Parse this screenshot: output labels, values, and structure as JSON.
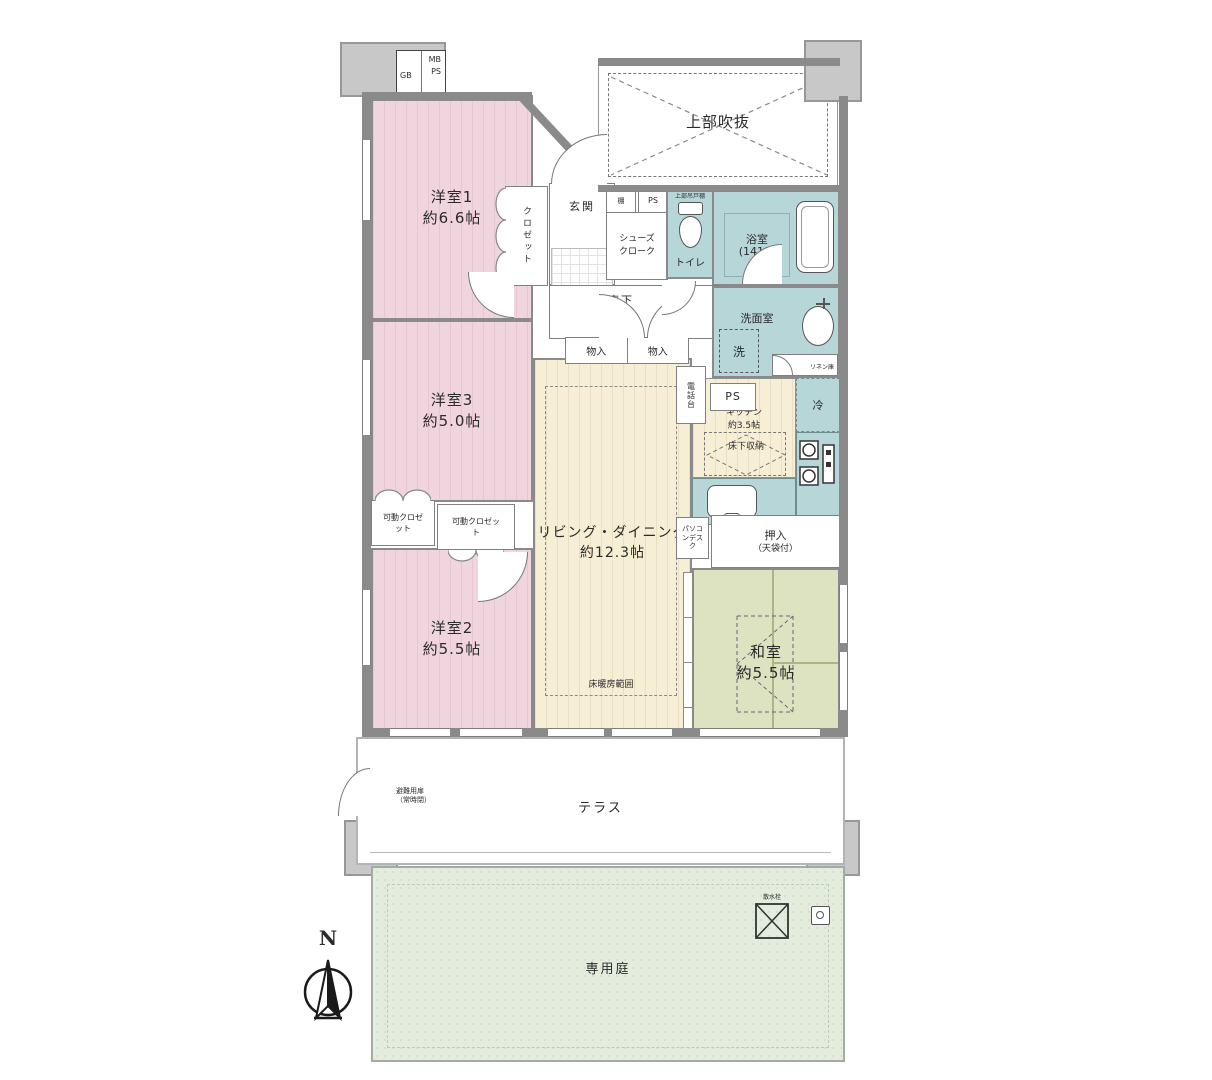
{
  "palette": {
    "bedroom_pink": "#f0d4de",
    "living_cream": "#f6efd6",
    "wet_area_blue": "#b7d6d8",
    "tatami_green": "#dde3c1",
    "garden_green": "#e4eddd",
    "wall_gray": "#8a8a8a"
  },
  "compass": {
    "north": "N"
  },
  "meter_box": {
    "gb": "GB",
    "mb": "MB",
    "ps": "PS"
  },
  "atrium": {
    "label": "上部吹抜"
  },
  "entrance": {
    "label": "玄関",
    "shoes_cloak": "シューズクローク",
    "shelf": "棚",
    "ps": "PS"
  },
  "hallway": {
    "label": "廊下",
    "storage_left": "物入",
    "storage_right": "物入"
  },
  "bedroom1": {
    "name": "洋室1",
    "area": "約6.6帖",
    "closet": "クロゼット"
  },
  "bedroom3": {
    "name": "洋室3",
    "area": "約5.0帖"
  },
  "bedroom2": {
    "name": "洋室2",
    "area": "約5.5帖"
  },
  "movable_closets": {
    "left": "可動クロゼット",
    "right": "可動クロゼット"
  },
  "living": {
    "name": "リビング・ダイニング",
    "area": "約12.3帖",
    "floor_heating": "床暖房範囲",
    "pc_desk": "パソコンデスク",
    "phone_stand": "電話台",
    "ps": "PS"
  },
  "kitchen": {
    "name": "キッチン",
    "area": "約3.5帖",
    "underfloor": "床下収納",
    "fridge": "冷"
  },
  "toilet": {
    "name": "トイレ",
    "upper_cabinet": "上部吊戸棚"
  },
  "bath": {
    "name": "浴室",
    "size": "(1418)"
  },
  "washroom": {
    "name": "洗面室",
    "washer": "洗",
    "linen": "リネン庫"
  },
  "washitsu": {
    "name": "和室",
    "area": "約5.5帖",
    "underfloor": "床下収納",
    "oshiire": "押入",
    "oshiire_note": "（天袋付）"
  },
  "terrace": {
    "label": "テラス",
    "escape_door": "避難用扉",
    "escape_door_note": "（常時閉）"
  },
  "garden": {
    "label": "専用庭",
    "sprinkler": "散水栓"
  }
}
